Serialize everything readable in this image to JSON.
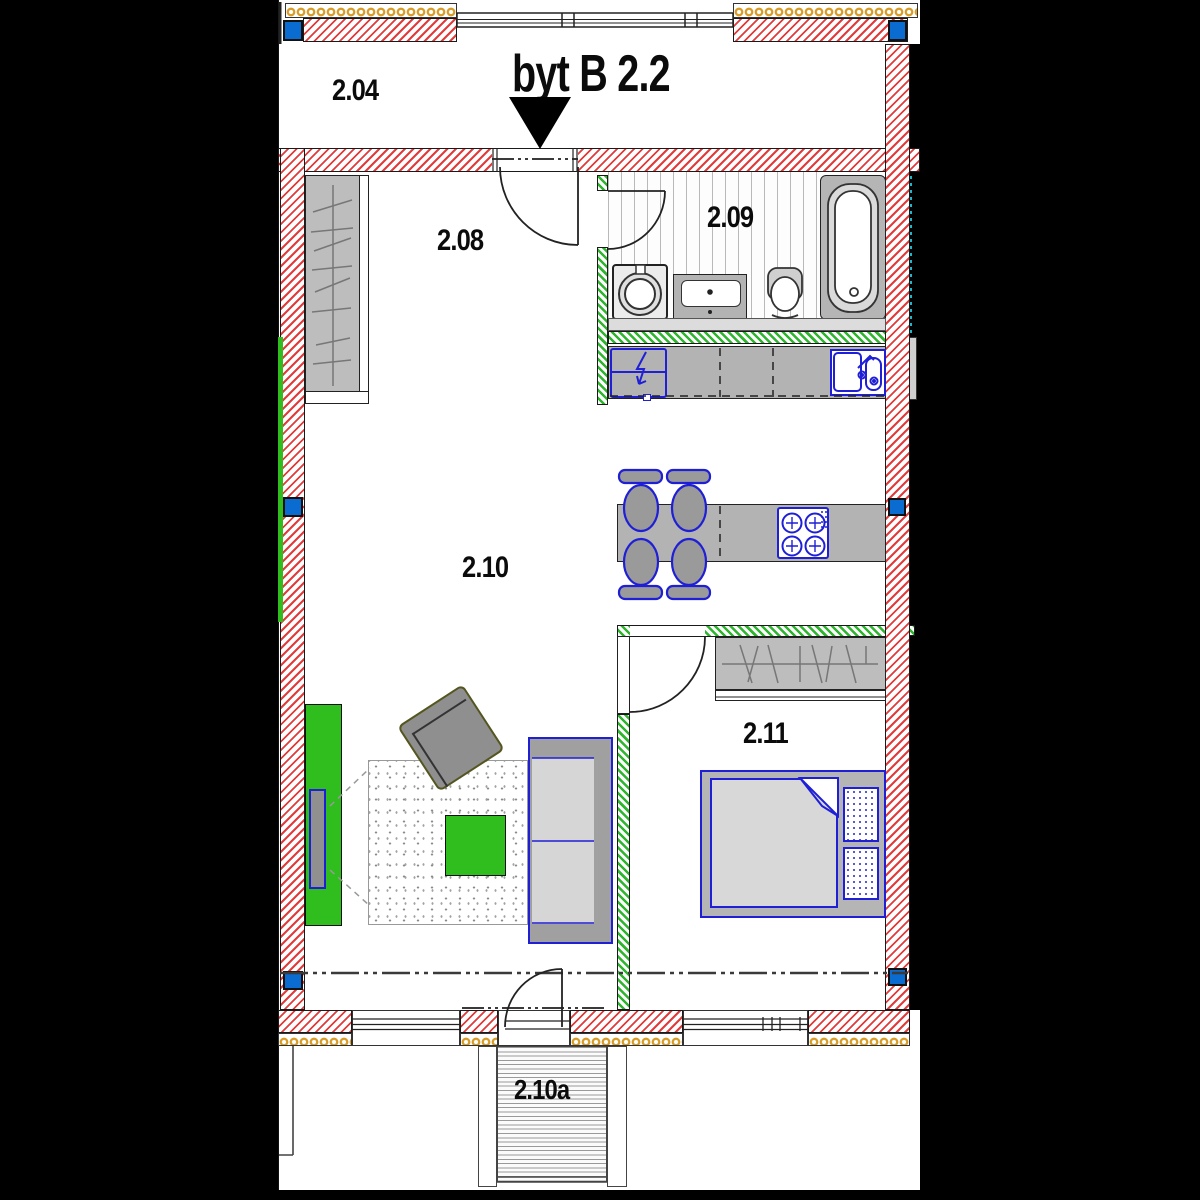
{
  "title": "byt B 2.2",
  "rooms": {
    "corridor": "2.04",
    "hall": "2.08",
    "bathroom": "2.09",
    "living": "2.10",
    "balcony": "2.10a",
    "bedroom": "2.11"
  },
  "colors": {
    "wall_hatch_red": "#e23b3b",
    "partition_hatch_green": "#2db52d",
    "insulation_gold": "#d89b25",
    "column_blue": "#0a6bd0",
    "furniture_green": "#2fbe1e",
    "furniture_outline_blue": "#1f1fd6",
    "floor_white": "#ffffff",
    "background_black": "#000000"
  },
  "fixtures": [
    "entrance-door",
    "bathroom-door",
    "bedroom-door",
    "balcony-door",
    "hall-wardrobe",
    "washing-machine",
    "vanity-sink",
    "toilet",
    "bathtub",
    "fridge",
    "kitchen-counter",
    "kitchen-sink",
    "dining-table",
    "dining-chairs",
    "cooktop",
    "bedroom-wardrobe",
    "double-bed",
    "pillows",
    "sofa",
    "armchair",
    "rug",
    "coffee-table",
    "tv-sideboard",
    "tv",
    "staircase",
    "structural-columns",
    "section-line"
  ]
}
